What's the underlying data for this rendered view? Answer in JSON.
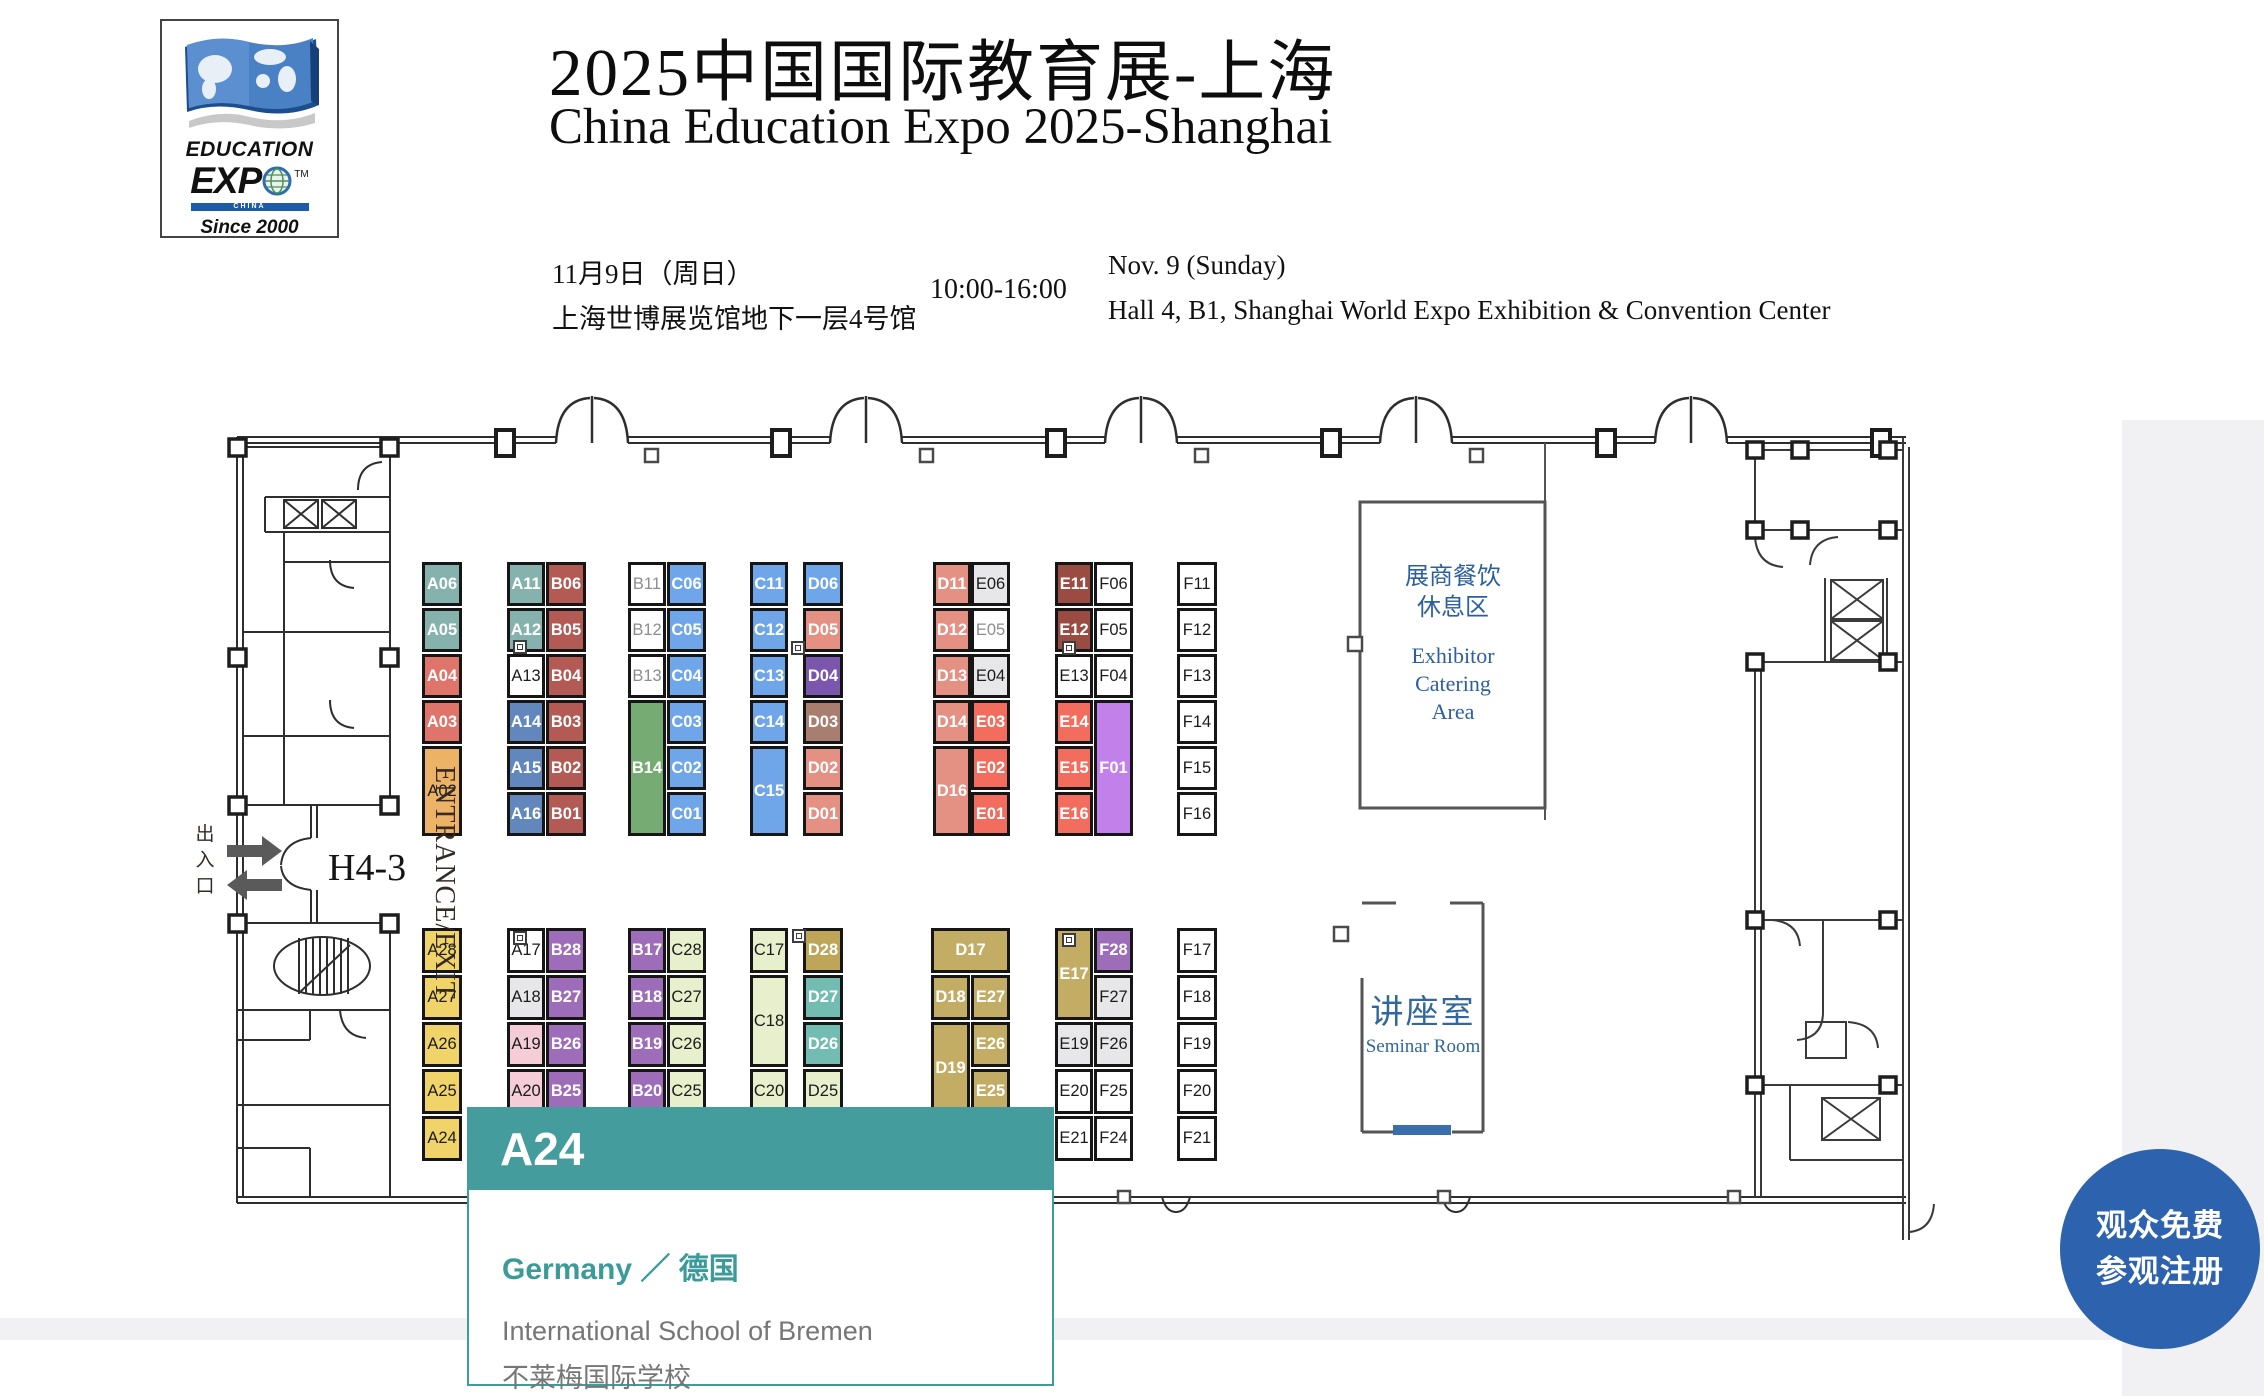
{
  "header": {
    "logo": {
      "education": "EDUCATION",
      "expo": "EXP",
      "tm": "TM",
      "china": "CHINA",
      "since": "Since 2000"
    },
    "title_zh": "2025中国国际教育展-上海",
    "title_en": "China Education Expo 2025-Shanghai",
    "date_zh": "11月9日（周日）",
    "venue_zh": "上海世博展览馆地下一层4号馆",
    "time": "10:00-16:00",
    "date_en": "Nov. 9 (Sunday)",
    "venue_en": "Hall 4, B1, Shanghai World Expo Exhibition & Convention Center"
  },
  "map": {
    "labels": {
      "entrance_vertical": "ENTRANCE/EXIT",
      "entrance_zh": "出入口",
      "gate": "H4-3",
      "catering_zh": "展商餐饮\n休息区",
      "catering_en": "Exhibitor\nCatering\nArea",
      "seminar_zh": "讲座室",
      "seminar_en": "Seminar Room"
    },
    "booths": [
      [
        "A06",
        422,
        562,
        40,
        44,
        "teal",
        "w"
      ],
      [
        "A05",
        422,
        608,
        40,
        44,
        "teal",
        "w"
      ],
      [
        "A04",
        422,
        654,
        40,
        44,
        "red",
        "w"
      ],
      [
        "A03",
        422,
        700,
        40,
        44,
        "red",
        "w"
      ],
      [
        "A02",
        422,
        746,
        40,
        90,
        "orange",
        "b"
      ],
      [
        "A11",
        507,
        562,
        38,
        44,
        "teal",
        "w"
      ],
      [
        "A12",
        507,
        608,
        38,
        44,
        "teal",
        "w"
      ],
      [
        "A13",
        507,
        654,
        38,
        44,
        "white",
        "b"
      ],
      [
        "A14",
        507,
        700,
        38,
        44,
        "blue",
        "w"
      ],
      [
        "A15",
        507,
        746,
        38,
        44,
        "blue",
        "w"
      ],
      [
        "A16",
        507,
        792,
        38,
        44,
        "blue",
        "w"
      ],
      [
        "B06",
        546,
        562,
        40,
        44,
        "darkred",
        "w"
      ],
      [
        "B05",
        546,
        608,
        40,
        44,
        "darkred",
        "w"
      ],
      [
        "B04",
        546,
        654,
        40,
        44,
        "darkred",
        "w"
      ],
      [
        "B03",
        546,
        700,
        40,
        44,
        "darkred",
        "w"
      ],
      [
        "B02",
        546,
        746,
        40,
        44,
        "darkred",
        "w"
      ],
      [
        "B01",
        546,
        792,
        40,
        44,
        "darkred",
        "w"
      ],
      [
        "B11",
        628,
        562,
        38,
        44,
        "white",
        "g"
      ],
      [
        "B12",
        628,
        608,
        38,
        44,
        "white",
        "g"
      ],
      [
        "B13",
        628,
        654,
        38,
        44,
        "white",
        "g"
      ],
      [
        "B14",
        628,
        700,
        38,
        136,
        "green",
        "w"
      ],
      [
        "C06",
        667,
        562,
        39,
        44,
        "lblue",
        "w"
      ],
      [
        "C05",
        667,
        608,
        39,
        44,
        "lblue",
        "w"
      ],
      [
        "C04",
        667,
        654,
        39,
        44,
        "lblue",
        "w"
      ],
      [
        "C03",
        667,
        700,
        39,
        44,
        "lblue",
        "w"
      ],
      [
        "C02",
        667,
        746,
        39,
        44,
        "lblue",
        "w"
      ],
      [
        "C01",
        667,
        792,
        39,
        44,
        "lblue",
        "w"
      ],
      [
        "C11",
        750,
        562,
        38,
        44,
        "lblue",
        "w"
      ],
      [
        "C12",
        750,
        608,
        38,
        44,
        "lblue",
        "w"
      ],
      [
        "C13",
        750,
        654,
        38,
        44,
        "lblue",
        "w"
      ],
      [
        "C14",
        750,
        700,
        38,
        44,
        "lblue",
        "w"
      ],
      [
        "C15",
        750,
        746,
        38,
        90,
        "lblue",
        "w"
      ],
      [
        "D06",
        803,
        562,
        40,
        44,
        "lblue",
        "w"
      ],
      [
        "D05",
        803,
        608,
        40,
        44,
        "dsalmon",
        "w"
      ],
      [
        "D04",
        803,
        654,
        40,
        44,
        "purpled",
        "w"
      ],
      [
        "D03",
        803,
        700,
        40,
        44,
        "brown",
        "w"
      ],
      [
        "D02",
        803,
        746,
        40,
        44,
        "dsalmon",
        "w"
      ],
      [
        "D01",
        803,
        792,
        40,
        44,
        "dsalmon",
        "w"
      ],
      [
        "D11",
        933,
        562,
        38,
        44,
        "dsalmon",
        "w"
      ],
      [
        "D12",
        933,
        608,
        38,
        44,
        "dsalmon",
        "w"
      ],
      [
        "D13",
        933,
        654,
        38,
        44,
        "dsalmon",
        "w"
      ],
      [
        "D14",
        933,
        700,
        38,
        44,
        "dsalmon",
        "w"
      ],
      [
        "D16",
        933,
        746,
        38,
        90,
        "dsalmon",
        "w"
      ],
      [
        "E06",
        971,
        562,
        39,
        44,
        "lgray",
        "b"
      ],
      [
        "E05",
        971,
        608,
        39,
        44,
        "white",
        "g"
      ],
      [
        "E04",
        971,
        654,
        39,
        44,
        "lgray",
        "b"
      ],
      [
        "E03",
        971,
        700,
        39,
        44,
        "rede",
        "w"
      ],
      [
        "E02",
        971,
        746,
        39,
        44,
        "rede",
        "w"
      ],
      [
        "E01",
        971,
        792,
        39,
        44,
        "rede",
        "w"
      ],
      [
        "E11",
        1055,
        562,
        38,
        44,
        "maroon",
        "w"
      ],
      [
        "E12",
        1055,
        608,
        38,
        44,
        "maroon",
        "w"
      ],
      [
        "E13",
        1055,
        654,
        38,
        44,
        "white",
        "b"
      ],
      [
        "E14",
        1055,
        700,
        38,
        44,
        "rede",
        "w"
      ],
      [
        "E15",
        1055,
        746,
        38,
        44,
        "rede",
        "w"
      ],
      [
        "E16",
        1055,
        792,
        38,
        44,
        "rede",
        "w"
      ],
      [
        "F06",
        1094,
        562,
        39,
        44,
        "white",
        "b"
      ],
      [
        "F05",
        1094,
        608,
        39,
        44,
        "white",
        "b"
      ],
      [
        "F04",
        1094,
        654,
        39,
        44,
        "white",
        "b"
      ],
      [
        "F01",
        1094,
        700,
        39,
        136,
        "violet",
        "w"
      ],
      [
        "F11",
        1177,
        562,
        40,
        44,
        "white",
        "b"
      ],
      [
        "F12",
        1177,
        608,
        40,
        44,
        "white",
        "b"
      ],
      [
        "F13",
        1177,
        654,
        40,
        44,
        "white",
        "b"
      ],
      [
        "F14",
        1177,
        700,
        40,
        44,
        "white",
        "b"
      ],
      [
        "F15",
        1177,
        746,
        40,
        44,
        "white",
        "b"
      ],
      [
        "F16",
        1177,
        792,
        40,
        44,
        "white",
        "b"
      ],
      [
        "A28",
        422,
        928,
        40,
        45,
        "yellow",
        "b"
      ],
      [
        "A27",
        422,
        975,
        40,
        45,
        "yellow",
        "b"
      ],
      [
        "A26",
        422,
        1022,
        40,
        45,
        "yellow",
        "b"
      ],
      [
        "A25",
        422,
        1069,
        40,
        45,
        "yellow",
        "b"
      ],
      [
        "A24",
        422,
        1116,
        40,
        45,
        "yellow",
        "b"
      ],
      [
        "A17",
        507,
        928,
        38,
        45,
        "white",
        "b"
      ],
      [
        "A18",
        507,
        975,
        38,
        45,
        "lgray",
        "b"
      ],
      [
        "A19",
        507,
        1022,
        38,
        45,
        "pink",
        "b"
      ],
      [
        "A20",
        507,
        1069,
        38,
        45,
        "pink",
        "b"
      ],
      [
        "B28",
        546,
        928,
        40,
        45,
        "purpleb",
        "w"
      ],
      [
        "B27",
        546,
        975,
        40,
        45,
        "purpleb",
        "w"
      ],
      [
        "B26",
        546,
        1022,
        40,
        45,
        "purpleb",
        "w"
      ],
      [
        "B25",
        546,
        1069,
        40,
        45,
        "purpleb",
        "w"
      ],
      [
        "B17",
        628,
        928,
        38,
        45,
        "purpleb",
        "w"
      ],
      [
        "B18",
        628,
        975,
        38,
        45,
        "purpleb",
        "w"
      ],
      [
        "B19",
        628,
        1022,
        38,
        45,
        "purpleb",
        "w"
      ],
      [
        "B20",
        628,
        1069,
        38,
        45,
        "purpleb",
        "w"
      ],
      [
        "C28",
        667,
        928,
        39,
        45,
        "pgreen",
        "b"
      ],
      [
        "C27",
        667,
        975,
        39,
        45,
        "pgreen",
        "b"
      ],
      [
        "C26",
        667,
        1022,
        39,
        45,
        "pgreen",
        "b"
      ],
      [
        "C25",
        667,
        1069,
        39,
        45,
        "pgreen",
        "b"
      ],
      [
        "C17",
        750,
        928,
        38,
        45,
        "pgreen",
        "b"
      ],
      [
        "C18",
        750,
        975,
        38,
        92,
        "pgreen",
        "b"
      ],
      [
        "C20",
        750,
        1069,
        38,
        45,
        "pgreen",
        "b"
      ],
      [
        "D28",
        803,
        928,
        40,
        45,
        "khaki2",
        "w"
      ],
      [
        "D27",
        803,
        975,
        40,
        45,
        "teald",
        "w"
      ],
      [
        "D26",
        803,
        1022,
        40,
        45,
        "teald",
        "w"
      ],
      [
        "D25",
        803,
        1069,
        40,
        45,
        "pgreen",
        "b"
      ],
      [
        "D17",
        931,
        928,
        79,
        45,
        "khaki",
        "w"
      ],
      [
        "D18",
        931,
        975,
        39,
        45,
        "khaki",
        "w"
      ],
      [
        "E27",
        971,
        975,
        39,
        45,
        "khaki",
        "w"
      ],
      [
        "D19",
        931,
        1022,
        39,
        92,
        "khaki",
        "w"
      ],
      [
        "E26",
        971,
        1022,
        39,
        45,
        "khaki",
        "w"
      ],
      [
        "E25",
        971,
        1069,
        39,
        45,
        "khaki",
        "w"
      ],
      [
        "E17",
        1055,
        928,
        38,
        92,
        "khaki",
        "w"
      ],
      [
        "F28",
        1094,
        928,
        39,
        45,
        "purpleb",
        "w"
      ],
      [
        "F27",
        1094,
        975,
        39,
        45,
        "lgray",
        "b"
      ],
      [
        "E19",
        1055,
        1022,
        38,
        45,
        "lgray",
        "b"
      ],
      [
        "F26",
        1094,
        1022,
        39,
        45,
        "lgray",
        "b"
      ],
      [
        "E20",
        1055,
        1069,
        38,
        45,
        "white",
        "b"
      ],
      [
        "F25",
        1094,
        1069,
        39,
        45,
        "white",
        "b"
      ],
      [
        "E21",
        1055,
        1116,
        38,
        45,
        "white",
        "b"
      ],
      [
        "F24",
        1094,
        1116,
        39,
        45,
        "white",
        "b"
      ],
      [
        "F17",
        1177,
        928,
        40,
        45,
        "white",
        "b"
      ],
      [
        "F18",
        1177,
        975,
        40,
        45,
        "white",
        "b"
      ],
      [
        "F19",
        1177,
        1022,
        40,
        45,
        "white",
        "b"
      ],
      [
        "F20",
        1177,
        1069,
        40,
        45,
        "white",
        "b"
      ],
      [
        "F21",
        1177,
        1116,
        40,
        45,
        "white",
        "b"
      ]
    ],
    "door_icons": [
      [
        513,
        640
      ],
      [
        791,
        641
      ],
      [
        1062,
        641
      ],
      [
        513,
        931
      ],
      [
        792,
        929
      ],
      [
        1062,
        933
      ]
    ]
  },
  "palette": {
    "teal": "#86b2ae",
    "red": "#df746b",
    "orange": "#ecb366",
    "darkred": "#b45a54",
    "blue": "#6287bd",
    "lblue": "#6ea6e9",
    "green": "#76ac73",
    "purpled": "#7b56ad",
    "brown": "#a87e70",
    "dsalmon": "#e49183",
    "lgray": "#e7e7e9",
    "white": "#ffffff",
    "rede": "#f26d5e",
    "maroon": "#9a4c43",
    "violet": "#c280ea",
    "yellow": "#f1d469",
    "purpleb": "#9d6db9",
    "pink": "#f4cdd9",
    "pgreen": "#e7efcc",
    "khaki": "#c3ac63",
    "khaki2": "#bfa557",
    "teald": "#73bcb2"
  },
  "popup": {
    "booth": "A24",
    "country": "Germany ／ 德国",
    "name_en": "International School of Bremen",
    "name_zh": "不莱梅国际学校",
    "accent": "#449c9d"
  },
  "register_button": {
    "line1": "观众免费",
    "line2": "参观注册",
    "color": "#2d63ae"
  }
}
